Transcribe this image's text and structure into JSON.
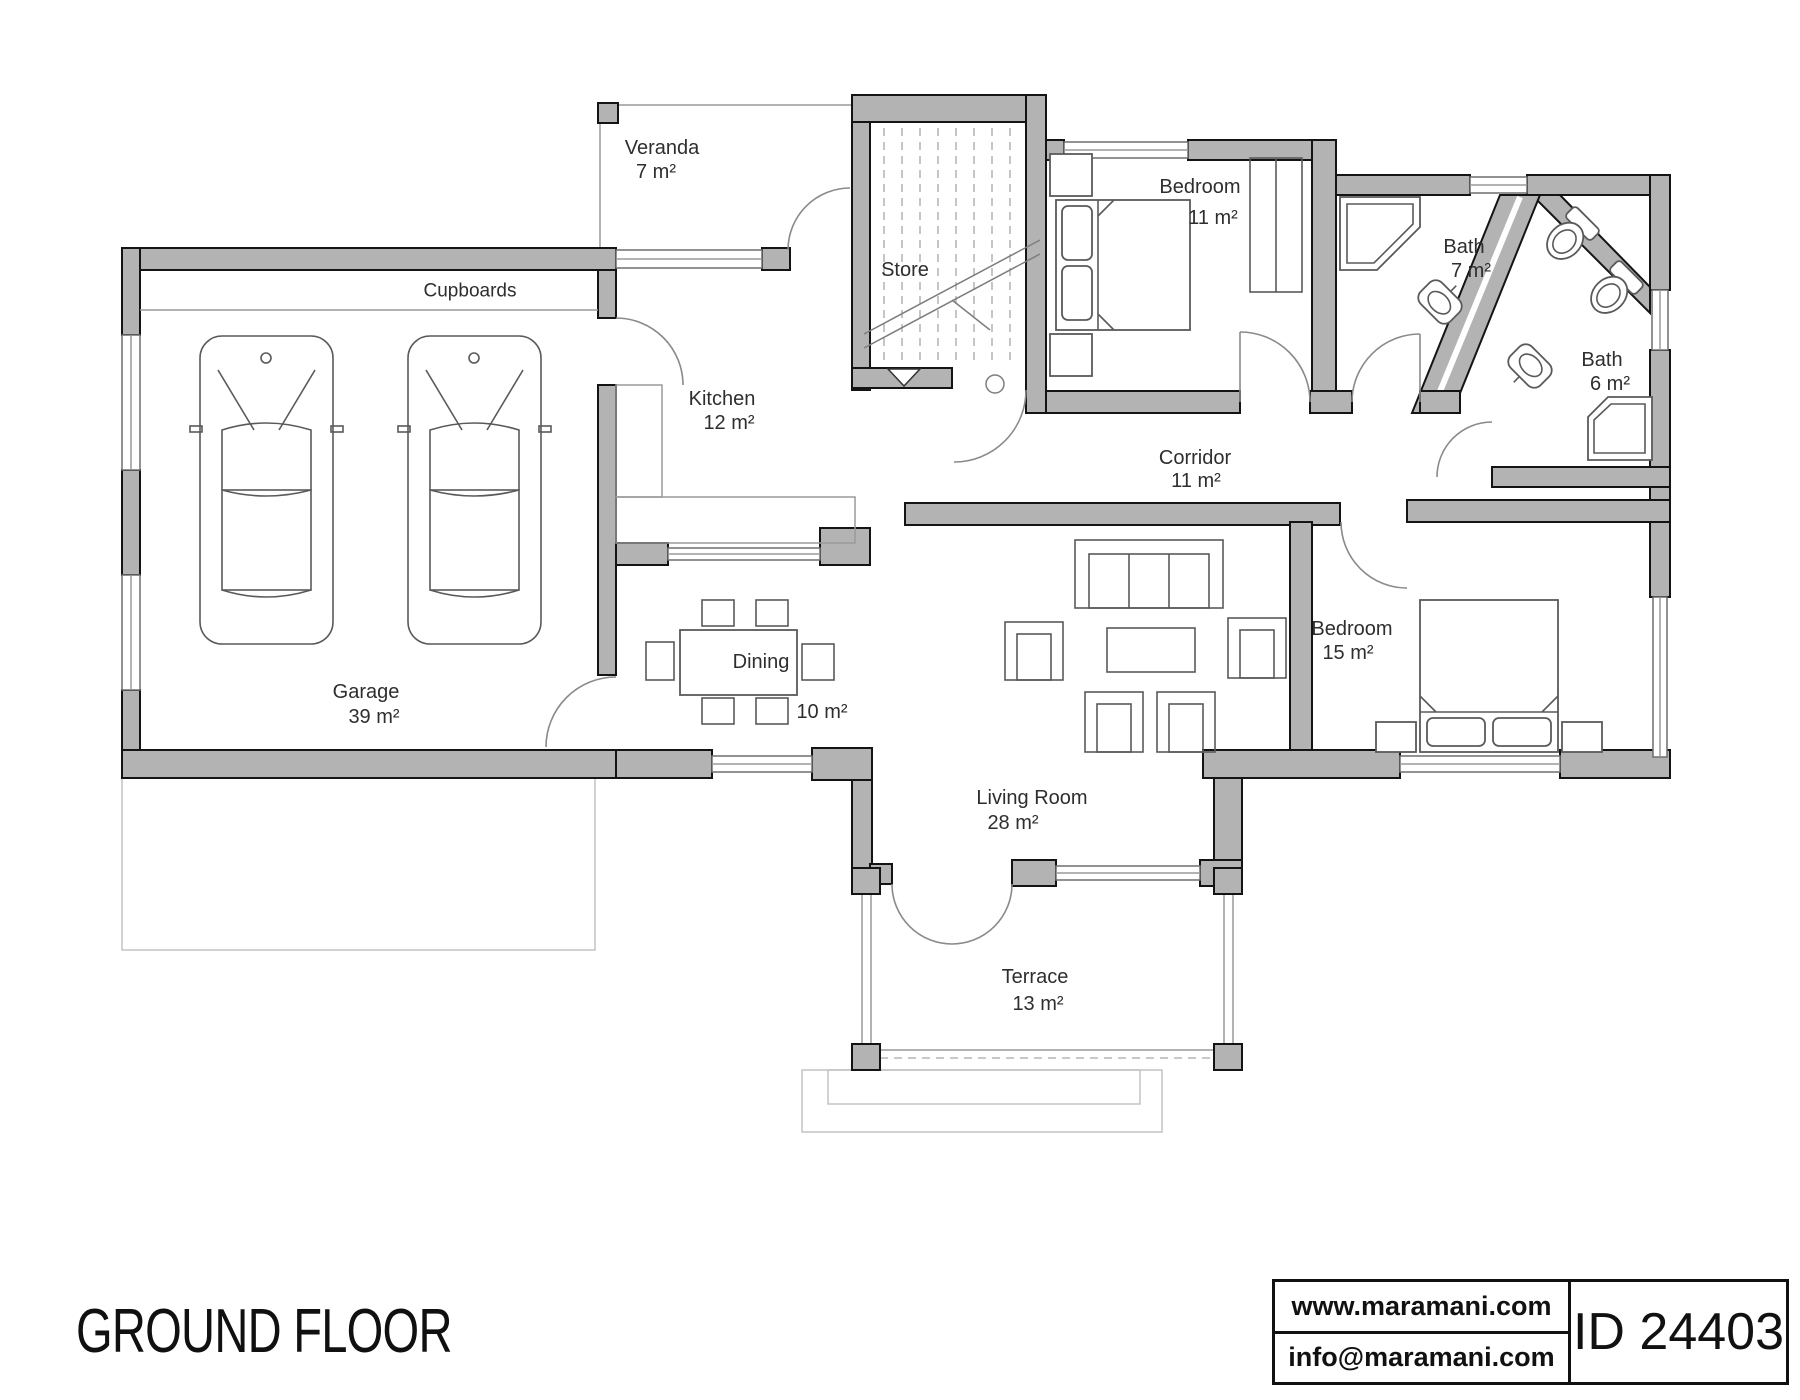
{
  "title": "GROUND FLOOR",
  "footer": {
    "website": "www.maramani.com",
    "email": "info@maramani.com",
    "plan_id": "ID 24403"
  },
  "annotations": {
    "cupboards": "Cupboards"
  },
  "rooms": [
    {
      "id": "veranda",
      "name": "Veranda",
      "area": "7 m²"
    },
    {
      "id": "store",
      "name": "Store",
      "area": ""
    },
    {
      "id": "bedroom1",
      "name": "Bedroom",
      "area": "11 m²"
    },
    {
      "id": "bath1",
      "name": "Bath",
      "area": "7 m²"
    },
    {
      "id": "bath2",
      "name": "Bath",
      "area": "6 m²"
    },
    {
      "id": "kitchen",
      "name": "Kitchen",
      "area": "12 m²"
    },
    {
      "id": "corridor",
      "name": "Corridor",
      "area": "11 m²"
    },
    {
      "id": "dining",
      "name": "Dining",
      "area": "10 m²"
    },
    {
      "id": "garage",
      "name": "Garage",
      "area": "39 m²"
    },
    {
      "id": "bedroom2",
      "name": "Bedroom",
      "area": "15 m²"
    },
    {
      "id": "living",
      "name": "Living Room",
      "area": "28 m²"
    },
    {
      "id": "terrace",
      "name": "Terrace",
      "area": "13 m²"
    }
  ]
}
